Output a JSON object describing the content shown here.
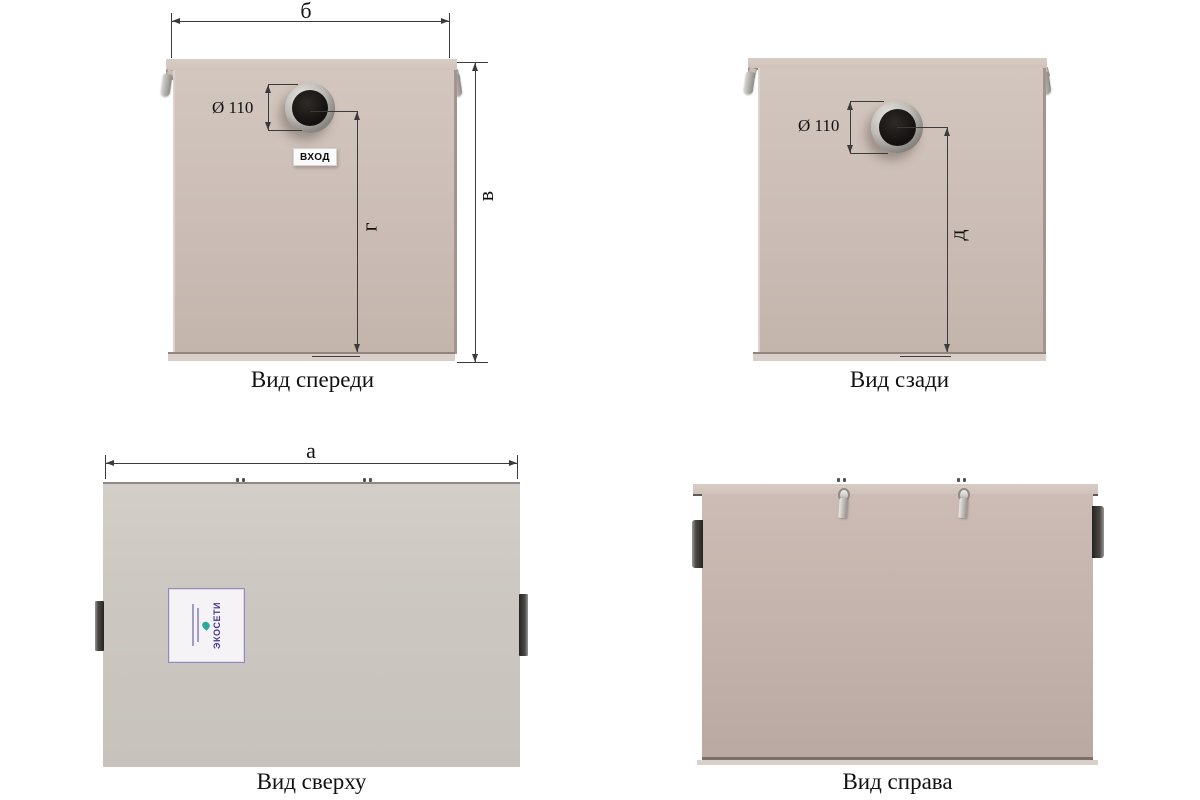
{
  "drawing": {
    "front": {
      "caption": "Вид спереди",
      "pipe_diameter": "Ø 110",
      "port_label": "ВХОД",
      "dim_top": "б",
      "dim_right": "в",
      "dim_center": "г"
    },
    "back": {
      "caption": "Вид сзади",
      "pipe_diameter": "Ø 110",
      "dim_center": "д"
    },
    "top": {
      "caption": "Вид сверху",
      "dim_top": "а",
      "sticker_brand": "ЭКОСЕТИ"
    },
    "right": {
      "caption": "Вид справа"
    }
  }
}
